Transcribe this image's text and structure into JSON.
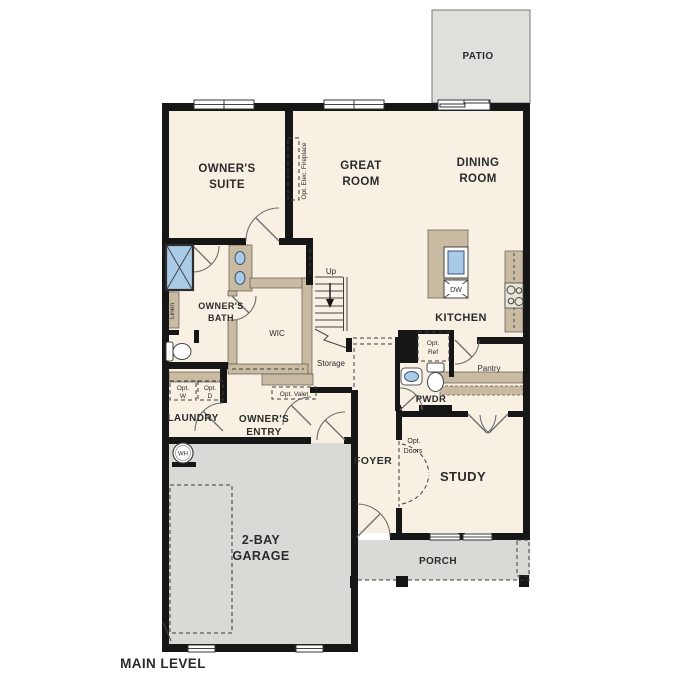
{
  "title": "MAIN LEVEL",
  "rooms": {
    "patio": "PATIO",
    "owners_suite": [
      "OWNER'S",
      "SUITE"
    ],
    "great_room": [
      "GREAT",
      "ROOM"
    ],
    "dining_room": [
      "DINING",
      "ROOM"
    ],
    "kitchen": "KITCHEN",
    "owners_bath": [
      "OWNER'S",
      "BATH"
    ],
    "wic": "WIC",
    "linen": "Linen",
    "laundry": "LAUNDRY",
    "owners_entry": [
      "OWNER'S",
      "ENTRY"
    ],
    "pwdr": "PWDR",
    "pantry": "Pantry",
    "storage": "Storage",
    "foyer": "FOYER",
    "study": "STUDY",
    "garage": [
      "2-BAY",
      "GARAGE"
    ],
    "porch": "PORCH"
  },
  "annotations": {
    "up": "Up",
    "dw": "DW",
    "wh": "WH",
    "opt_elec_fireplace": "Opt. Elec. Fireplace",
    "opt_ref": [
      "Opt.",
      "Ref"
    ],
    "opt_w": [
      "Opt.",
      "W"
    ],
    "opt_d": [
      "Opt.",
      "D"
    ],
    "opt_valet": "Opt. Valet",
    "opt_doors": [
      "Opt.",
      "Doors"
    ]
  },
  "colors": {
    "room_fill": "#f8f1e3",
    "outdoor_fill": "#dcddd8",
    "cabinet_fill": "#c8bba2",
    "fixture_blue": "#a9cbe8",
    "wall": "#161616"
  }
}
